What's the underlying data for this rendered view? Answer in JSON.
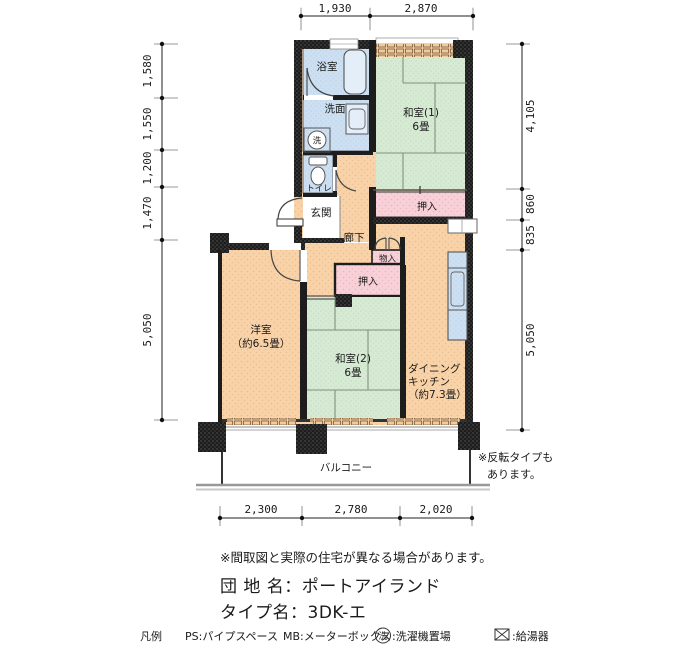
{
  "plan": {
    "dims": {
      "top": [
        "1,930",
        "2,870"
      ],
      "left": [
        "1,580",
        "1,550",
        "1,200",
        "1,470",
        "5,050"
      ],
      "right": [
        "4,105",
        "860",
        "835",
        "5,050"
      ],
      "bottom": [
        "2,300",
        "2,780",
        "2,020"
      ]
    },
    "rooms": {
      "bath": "浴室",
      "wash": "洗面",
      "washer_mark": "洗",
      "toilet": "トイレ",
      "entrance": "玄関",
      "hall": "廊下",
      "jroom1": "和室(1)",
      "jroom1_size": "6畳",
      "closet1": "押入",
      "storage": "物入",
      "closet2": "押入",
      "wroom": "洋室",
      "wroom_size": "（約6.5畳）",
      "jroom2": "和室(2)",
      "jroom2_size": "6畳",
      "dk1": "ダイニング・",
      "dk2": "キッチン",
      "dk3": "（約7.3畳）",
      "balcony": "バルコニー"
    },
    "side_note": [
      "※反転タイプも",
      "あります。"
    ]
  },
  "footer": {
    "disclaimer": "※間取図と実際の住宅が異なる場合があります。",
    "estate": "団 地 名：ポートアイランド",
    "type": "タイプ名：3DK-エ",
    "legend": {
      "title": "凡例",
      "ps": "PS:パイプスペース",
      "mb": "MB:メーターボックス",
      "washer_mark": "洗",
      "washer_label": ":洗濯機置場",
      "boiler_label": ":給湯器"
    }
  },
  "colors": {
    "floor": "#f8d3a9",
    "tatami": "#d6ead4",
    "closet_pink": "#f8d1d8",
    "fixture_blue": "#cde0f2",
    "wall": "#1d1d1d"
  }
}
